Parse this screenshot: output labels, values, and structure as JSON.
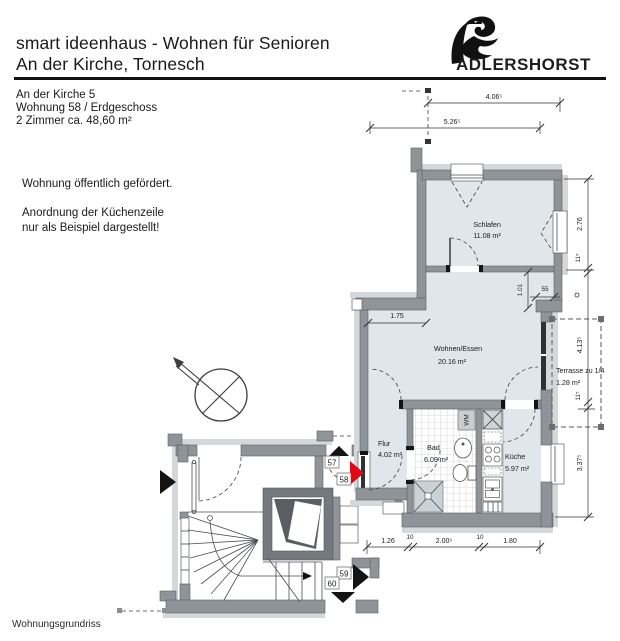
{
  "header": {
    "title_line1": "smart ideenhaus - Wohnen für Senioren",
    "title_line2": "An der Kirche, Tornesch",
    "logo_text": "ADLERSHORST"
  },
  "info": {
    "address": "An der Kirche 5",
    "unit": "Wohnung 58 / Erdgeschoss",
    "rooms": "2 Zimmer ca. 48,60 m²"
  },
  "notes": {
    "funding": "Wohnung öffentlich gefördert.",
    "kitchen_line1": "Anordnung der Küchenzeile",
    "kitchen_line2": "nur als Beispiel dargestellt!"
  },
  "footer": {
    "caption": "Wohnungsgrundriss"
  },
  "plan": {
    "rooms": [
      {
        "name": "Schlafen",
        "area": "11.08 m²"
      },
      {
        "name": "Wohnen/Essen",
        "area": "20.16 m²"
      },
      {
        "name": "Terrasse zu 1/4",
        "area": "1.28 m²"
      },
      {
        "name": "Flur",
        "area": "4.02 m²"
      },
      {
        "name": "Bad",
        "area": "6.09 m²"
      },
      {
        "name": "Küche",
        "area": "5.97 m²"
      }
    ],
    "appliance_label": "WM",
    "units": {
      "u57": "57",
      "u58": "58",
      "u59": "59",
      "u60": "60"
    },
    "dimensions": {
      "top_inner": "4.06⁵",
      "top_outer": "5.26⁵",
      "right_sleep": "2.76",
      "right_wall1": "11⁵",
      "right_terrace": "4.13⁵",
      "right_wall2": "11⁵",
      "right_lower": "3.37⁵",
      "bottom_flur": "1.26",
      "bottom_wall1": "10",
      "bottom_bad": "2.00⁵",
      "bottom_wall2": "10",
      "bottom_kueche": "1.80",
      "wohnen_width": "1.75",
      "niche_height": "1.01",
      "niche_width": "55"
    },
    "colors": {
      "wall_gray": "#8f9499",
      "wall_dark": "#74797d",
      "room_fill": "#e1e6eb",
      "outer_band": "#d4d8db",
      "entrance_marker_red": "#e30613",
      "marker_black": "#141414"
    }
  }
}
